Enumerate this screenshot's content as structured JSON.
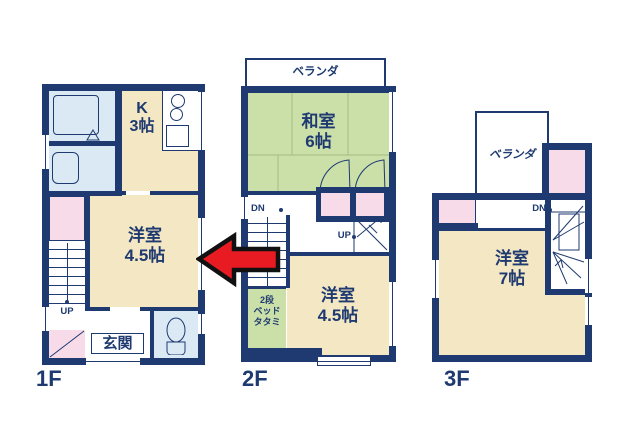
{
  "title": "3-story house floor plan",
  "colors": {
    "wall": "#1e3a70",
    "cream": "#f4e7c3",
    "green": "#cbdfa9",
    "blue": "#dbe9f4",
    "pink": "#f8dbe9",
    "red": "#e81b23",
    "text": "#1e3a70"
  },
  "floor1": {
    "label": "1F",
    "kitchen": {
      "name": "K",
      "size": "3帖"
    },
    "western": {
      "name": "洋室",
      "size": "4.5帖"
    },
    "entrance": "玄関",
    "up": "UP"
  },
  "floor2": {
    "label": "2F",
    "veranda": "ベランダ",
    "japanese": {
      "name": "和室",
      "size": "6帖"
    },
    "western": {
      "name": "洋室",
      "size": "4.5帖"
    },
    "bunk": {
      "line1": "2段",
      "line2": "ベッド",
      "line3": "タタミ"
    },
    "dn": "DN",
    "up": "UP"
  },
  "floor3": {
    "label": "3F",
    "veranda": "ベランダ",
    "western": {
      "name": "洋室",
      "size": "7帖"
    },
    "dn": "DN"
  }
}
